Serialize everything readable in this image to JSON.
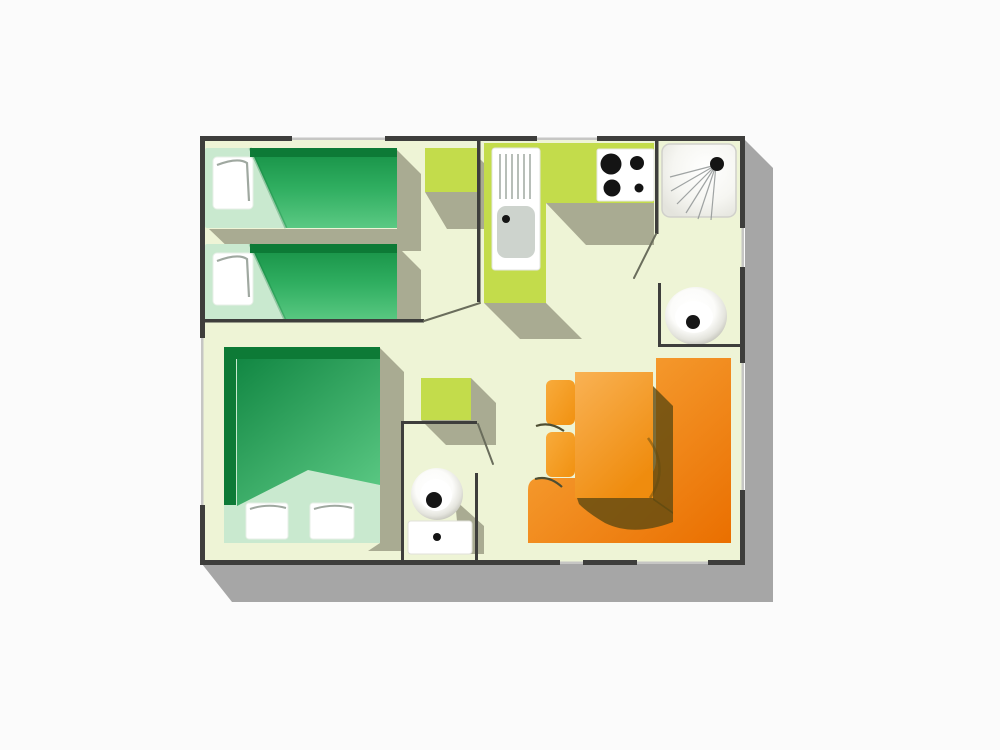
{
  "diagram": {
    "type": "floor-plan",
    "description": "Top-down floor plan of a small mobile home: twin bedroom with two single beds, double bedroom, L-shaped kitchen with sink and 4-burner cooktop, shower room, washbasin nook, separate WC, and a dining area with orange table, two chairs and a corner bench.",
    "rooms": [
      "twin-bedroom",
      "double-bedroom",
      "kitchen",
      "shower-room",
      "washbasin-nook",
      "wc",
      "living-dining-area"
    ],
    "furniture": [
      "single-bed-1",
      "single-bed-2",
      "bedside-cabinet",
      "kitchen-counter",
      "kitchen-sink",
      "cooktop",
      "shower",
      "washbasin",
      "storage-cabinet",
      "toilet",
      "dining-table",
      "dining-chair-1",
      "dining-chair-2",
      "corner-bench",
      "double-bed"
    ]
  },
  "colors": {
    "page-bg": "#fbfbfb",
    "floor": "#eef4d6",
    "wall": "#3e3e3c",
    "window": "#c6c6c4",
    "building-shadow": "#a6a6a6",
    "furniture-shadow": "#a9ab92",
    "cabinet-green": "#c3dc4b",
    "bed-dark-green": "#0d7a36",
    "bed-green": "#2fae60",
    "bed-light-green": "#5bc983",
    "sheet-green": "#c9e9cf",
    "pillow-white": "#ffffff",
    "pillow-line": "#9fa8a0",
    "sink-gray": "#cdd3cd",
    "drain-line": "#b7beb8",
    "burner-black": "#141414",
    "spray-gray": "#8f9494",
    "orange-light": "#f9ab40",
    "orange-dark": "#ea6f00",
    "table-orange": "#f9b254",
    "table-orange-deep": "#ef8c0e",
    "table-shadow": "#5f4a10",
    "door-line": "#6a6d5c"
  }
}
